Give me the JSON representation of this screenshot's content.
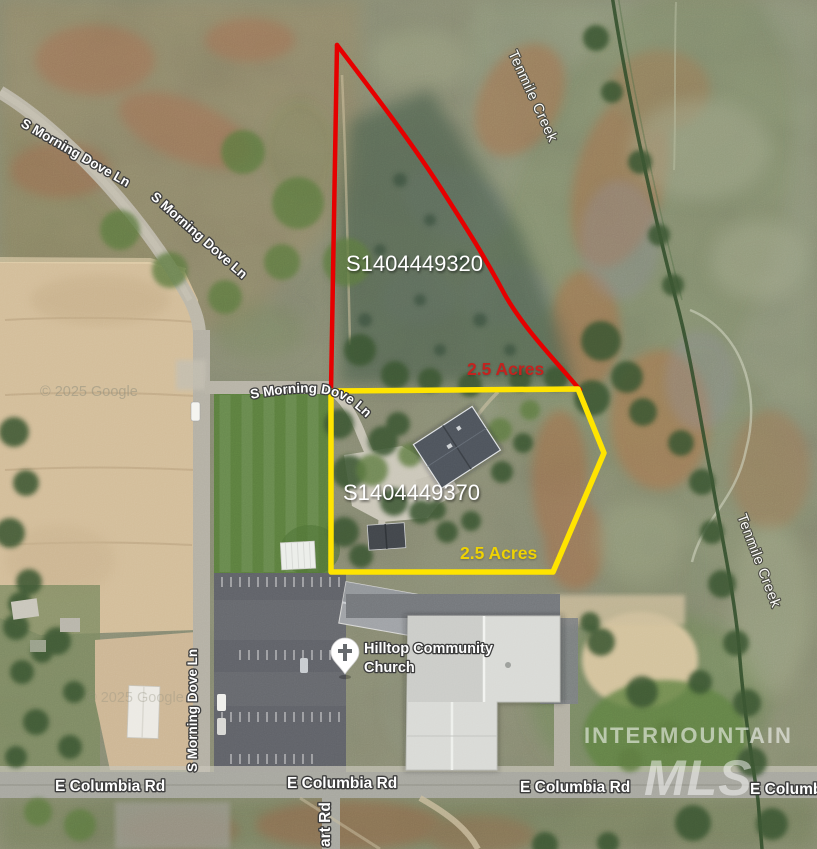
{
  "map": {
    "type": "satellite-parcel-map",
    "parcels": [
      {
        "id": "S1404449320",
        "acres": "2.5 Acres",
        "color": "#e60000",
        "acres_color": "#c3231f"
      },
      {
        "id": "S1404449370",
        "acres": "2.5 Acres",
        "color": "#ffe400",
        "acres_color": "#eed203"
      }
    ],
    "roads": {
      "morning_dove": "S Morning Dove Ln",
      "columbia": "E Columbia Rd",
      "art_rd": "art Rd"
    },
    "creek": {
      "name": "Tenmile Creek"
    },
    "church": {
      "line1": "Hilltop Community",
      "line2": "Church"
    },
    "watermarks": {
      "google": "© 2025 Google",
      "intermountain": "INTERMOUNTAIN",
      "mls": "MLS"
    }
  }
}
